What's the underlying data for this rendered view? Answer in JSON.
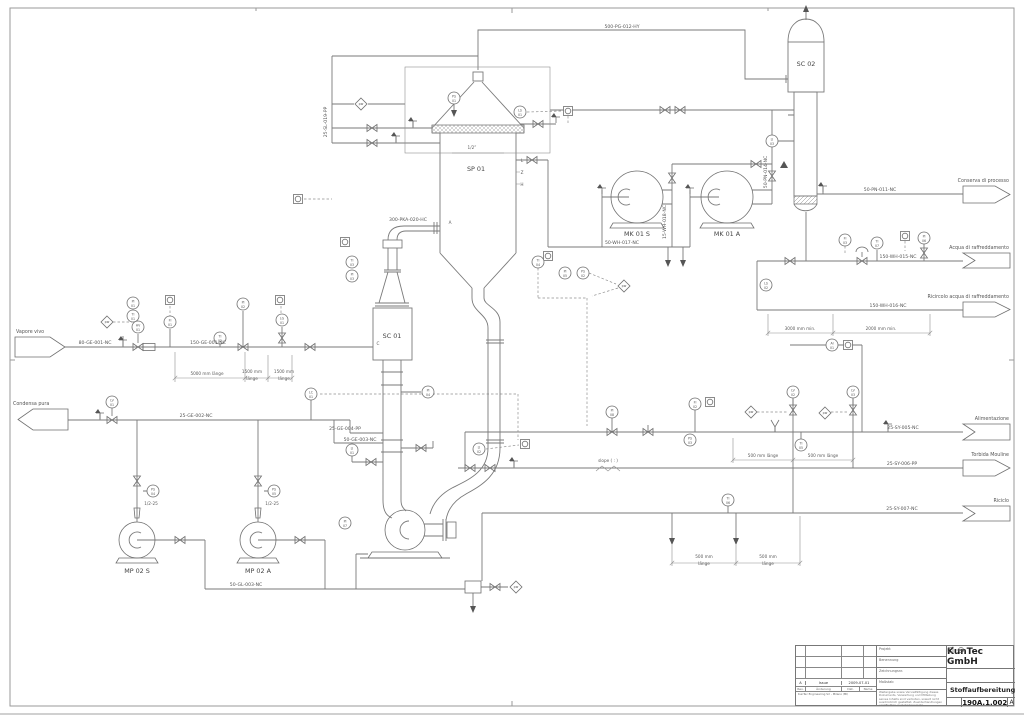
{
  "title_block": {
    "company": "KunTec GmbH",
    "drawing_title": "Stoffaufbereitung",
    "drawing_number": "190A.1.002",
    "revision": "A",
    "fields": [
      "Projekt",
      "Benennung",
      "Zeichnungsnr.",
      "Maßstab"
    ],
    "note": "Weitergabe sowie Vervielfältigung dieses Dokuments, Verwertung und Mitteilung seines Inhalts sind verboten, soweit nicht ausdrücklich gestattet. Zuwiderhandlungen verpflichten zu Schadenersatz.",
    "rev_row": {
      "rev": "A",
      "desc": "Issue",
      "date": "2009-07-01"
    },
    "rev_headers": [
      "Rev.",
      "Änderung",
      "Dat.",
      "Name"
    ],
    "footer": "KunTec Engineering Srl - Milano (MI)"
  },
  "diagram": {
    "equipment_labels": [
      {
        "text": "SC 02",
        "x": 806,
        "y": 66
      },
      {
        "text": "SP 01",
        "x": 476,
        "y": 171
      },
      {
        "text": "SC 01",
        "x": 392,
        "y": 338
      },
      {
        "text": "MK 01 S",
        "x": 637,
        "y": 236
      },
      {
        "text": "MK 01 A",
        "x": 727,
        "y": 236
      },
      {
        "text": "MP 02 S",
        "x": 137,
        "y": 573
      },
      {
        "text": "MP 02 A",
        "x": 258,
        "y": 573
      }
    ],
    "flags": [
      {
        "id": "vapore-vivo",
        "text": "Vapore vivo",
        "x": 15,
        "y": 337,
        "w": 50,
        "h": 20,
        "dir": "right",
        "lx": 16,
        "ly": 333,
        "anchor": "start"
      },
      {
        "id": "condensa-pura",
        "text": "Condensa pura",
        "x": 18,
        "y": 409,
        "w": 50,
        "h": 21,
        "dir": "left",
        "lx": 13,
        "ly": 405,
        "anchor": "start"
      },
      {
        "id": "conserva-di-processo",
        "text": "Conserva di processo",
        "x": 963,
        "y": 186,
        "w": 47,
        "h": 17,
        "dir": "right",
        "lx": 1009,
        "ly": 182,
        "anchor": "end"
      },
      {
        "id": "acqua-di-raffreddamento",
        "text": "Acqua di raffreddamento",
        "x": 963,
        "y": 253,
        "w": 47,
        "h": 15,
        "dir": "notch",
        "lx": 1009,
        "ly": 249,
        "anchor": "end"
      },
      {
        "id": "ricircolo-acqua",
        "text": "Ricircolo acqua di raffreddamento",
        "x": 963,
        "y": 302,
        "w": 47,
        "h": 15,
        "dir": "right",
        "lx": 1009,
        "ly": 298,
        "anchor": "end"
      },
      {
        "id": "alimentazione",
        "text": "Alimentazione",
        "x": 963,
        "y": 424,
        "w": 47,
        "h": 16,
        "dir": "notch",
        "lx": 1009,
        "ly": 420,
        "anchor": "end"
      },
      {
        "id": "torbida-mouline",
        "text": "Torbida Mouline",
        "x": 963,
        "y": 460,
        "w": 47,
        "h": 16,
        "dir": "right",
        "lx": 1009,
        "ly": 456,
        "anchor": "end"
      },
      {
        "id": "riciclo",
        "text": "Riciclo",
        "x": 963,
        "y": 506,
        "w": 47,
        "h": 15,
        "dir": "notch",
        "lx": 1009,
        "ly": 502,
        "anchor": "end"
      }
    ],
    "pipe_labels": [
      {
        "text": "500-PG-012-HY",
        "x": 622,
        "y": 28
      },
      {
        "text": "25-SL-019-PP",
        "x": 327,
        "y": 122,
        "rot": true
      },
      {
        "text": "300-PKA-020-HC",
        "x": 408,
        "y": 221
      },
      {
        "text": "80-GE-001-NC",
        "x": 95,
        "y": 344
      },
      {
        "text": "150-GE-001-NC",
        "x": 208,
        "y": 344
      },
      {
        "text": "25-GE-002-NC",
        "x": 196,
        "y": 417
      },
      {
        "text": "25-GE-004-PP",
        "x": 345,
        "y": 430
      },
      {
        "text": "50-GE-003-NC",
        "x": 360,
        "y": 441
      },
      {
        "text": "50-GL-003-NC",
        "x": 246,
        "y": 586
      },
      {
        "text": "50-WH-017-NC",
        "x": 622,
        "y": 244
      },
      {
        "text": "15-WH-018-NC",
        "x": 666,
        "y": 222,
        "rot": true
      },
      {
        "text": "50-PN-014-NC",
        "x": 767,
        "y": 172,
        "rot": true
      },
      {
        "text": "50-PN-011-NC",
        "x": 880,
        "y": 191
      },
      {
        "text": "150-WH-015-NC",
        "x": 898,
        "y": 258
      },
      {
        "text": "150-WH-016-NC",
        "x": 888,
        "y": 307
      },
      {
        "text": "25-SY-005-NC",
        "x": 903,
        "y": 429
      },
      {
        "text": "25-SY-006-PP",
        "x": 902,
        "y": 465
      },
      {
        "text": "25-SY-007-NC",
        "x": 902,
        "y": 510
      }
    ],
    "dimensions": [
      {
        "l1": "5000 mm länge",
        "l2": "",
        "x": 207,
        "y": 375
      },
      {
        "l1": "1500 mm",
        "l2": "länge",
        "x": 252,
        "y": 373
      },
      {
        "l1": "1500 mm",
        "l2": "länge",
        "x": 284,
        "y": 373
      },
      {
        "l1": "3000 mm min.",
        "l2": "",
        "x": 800,
        "y": 330
      },
      {
        "l1": "2000 mm min.",
        "l2": "",
        "x": 881,
        "y": 330
      },
      {
        "l1": "500 mm länge",
        "l2": "",
        "x": 763,
        "y": 457
      },
      {
        "l1": "500 mm länge",
        "l2": "",
        "x": 823,
        "y": 457
      },
      {
        "l1": "500 mm",
        "l2": "länge",
        "x": 704,
        "y": 558
      },
      {
        "l1": "500 mm",
        "l2": "länge",
        "x": 768,
        "y": 558
      }
    ],
    "notes": [
      {
        "text": "slope ( : )",
        "x": 608,
        "y": 462
      },
      {
        "text": "1/2”",
        "x": 472,
        "y": 149
      },
      {
        "text": "1/2-25",
        "x": 151,
        "y": 505
      },
      {
        "text": "1/2-25",
        "x": 272,
        "y": 505
      },
      {
        "text": "L",
        "x": 522,
        "y": 162
      },
      {
        "text": "Z",
        "x": 522,
        "y": 174
      },
      {
        "text": "H",
        "x": 522,
        "y": 186
      },
      {
        "text": "C",
        "x": 378,
        "y": 345
      },
      {
        "text": "A",
        "x": 450,
        "y": 224
      }
    ],
    "instruments": [
      {
        "x": 107,
        "y": 322,
        "l1": "pw",
        "l2": "",
        "shape": "d"
      },
      {
        "x": 133,
        "y": 303,
        "l1": "PI",
        "l2": "01",
        "shape": "c"
      },
      {
        "x": 133,
        "y": 316,
        "l1": "TI",
        "l2": "01",
        "shape": "c"
      },
      {
        "x": 170,
        "y": 300,
        "l1": "",
        "l2": "",
        "shape": "s"
      },
      {
        "x": 170,
        "y": 322,
        "l1": "FI",
        "l2": "01",
        "shape": "c"
      },
      {
        "x": 220,
        "y": 338,
        "l1": "TI",
        "l2": "02",
        "shape": "c"
      },
      {
        "x": 243,
        "y": 304,
        "l1": "PI",
        "l2": "02",
        "shape": "c"
      },
      {
        "x": 280,
        "y": 300,
        "l1": "",
        "l2": "",
        "shape": "s"
      },
      {
        "x": 282,
        "y": 320,
        "l1": "LG",
        "l2": "01",
        "shape": "c"
      },
      {
        "x": 311,
        "y": 394,
        "l1": "LC",
        "l2": "01",
        "shape": "c"
      },
      {
        "x": 112,
        "y": 402,
        "l1": "LV",
        "l2": "01",
        "shape": "c"
      },
      {
        "x": 138,
        "y": 327,
        "l1": "HV",
        "l2": "01",
        "shape": "c"
      },
      {
        "x": 345,
        "y": 242,
        "l1": "",
        "l2": "",
        "shape": "s"
      },
      {
        "x": 352,
        "y": 262,
        "l1": "TI",
        "l2": "03",
        "shape": "c"
      },
      {
        "x": 352,
        "y": 276,
        "l1": "PI",
        "l2": "03",
        "shape": "c"
      },
      {
        "x": 361,
        "y": 104,
        "l1": "pw",
        "l2": "",
        "shape": "d"
      },
      {
        "x": 454,
        "y": 98,
        "l1": "PS",
        "l2": "01",
        "shape": "c"
      },
      {
        "x": 520,
        "y": 112,
        "l1": "LS",
        "l2": "01",
        "shape": "c"
      },
      {
        "x": 568,
        "y": 111,
        "l1": "",
        "l2": "",
        "shape": "s"
      },
      {
        "x": 298,
        "y": 199,
        "l1": "",
        "l2": "",
        "shape": "s"
      },
      {
        "x": 548,
        "y": 256,
        "l1": "",
        "l2": "",
        "shape": "s"
      },
      {
        "x": 352,
        "y": 450,
        "l1": "LI",
        "l2": "01",
        "shape": "c"
      },
      {
        "x": 428,
        "y": 392,
        "l1": "PI",
        "l2": "04",
        "shape": "c"
      },
      {
        "x": 479,
        "y": 449,
        "l1": "LI",
        "l2": "02",
        "shape": "c"
      },
      {
        "x": 525,
        "y": 444,
        "l1": "",
        "l2": "",
        "shape": "s"
      },
      {
        "x": 538,
        "y": 262,
        "l1": "TI",
        "l2": "04",
        "shape": "c"
      },
      {
        "x": 565,
        "y": 273,
        "l1": "PI",
        "l2": "05",
        "shape": "c"
      },
      {
        "x": 583,
        "y": 273,
        "l1": "PS",
        "l2": "02",
        "shape": "c"
      },
      {
        "x": 624,
        "y": 286,
        "l1": "pw",
        "l2": "",
        "shape": "d"
      },
      {
        "x": 695,
        "y": 404,
        "l1": "FI",
        "l2": "02",
        "shape": "c"
      },
      {
        "x": 710,
        "y": 402,
        "l1": "",
        "l2": "",
        "shape": "s"
      },
      {
        "x": 690,
        "y": 440,
        "l1": "PS",
        "l2": "03",
        "shape": "c"
      },
      {
        "x": 751,
        "y": 412,
        "l1": "pw",
        "l2": "",
        "shape": "d"
      },
      {
        "x": 793,
        "y": 392,
        "l1": "LV",
        "l2": "02",
        "shape": "c"
      },
      {
        "x": 825,
        "y": 413,
        "l1": "pw",
        "l2": "",
        "shape": "d"
      },
      {
        "x": 853,
        "y": 392,
        "l1": "LV",
        "l2": "03",
        "shape": "c"
      },
      {
        "x": 801,
        "y": 445,
        "l1": "TI",
        "l2": "05",
        "shape": "c"
      },
      {
        "x": 728,
        "y": 500,
        "l1": "TI",
        "l2": "06",
        "shape": "c"
      },
      {
        "x": 612,
        "y": 412,
        "l1": "PI",
        "l2": "08",
        "shape": "c"
      },
      {
        "x": 832,
        "y": 345,
        "l1": "AI",
        "l2": "01",
        "shape": "c"
      },
      {
        "x": 848,
        "y": 345,
        "l1": "",
        "l2": "",
        "shape": "s"
      },
      {
        "x": 845,
        "y": 240,
        "l1": "FI",
        "l2": "03",
        "shape": "c"
      },
      {
        "x": 877,
        "y": 243,
        "l1": "TI",
        "l2": "07",
        "shape": "c"
      },
      {
        "x": 905,
        "y": 236,
        "l1": "",
        "l2": "",
        "shape": "s"
      },
      {
        "x": 924,
        "y": 238,
        "l1": "PI",
        "l2": "06",
        "shape": "c"
      },
      {
        "x": 772,
        "y": 141,
        "l1": "LI",
        "l2": "03",
        "shape": "c"
      },
      {
        "x": 766,
        "y": 285,
        "l1": "LS",
        "l2": "02",
        "shape": "c"
      },
      {
        "x": 153,
        "y": 491,
        "l1": "PS",
        "l2": "04",
        "shape": "c"
      },
      {
        "x": 274,
        "y": 491,
        "l1": "PS",
        "l2": "05",
        "shape": "c"
      },
      {
        "x": 345,
        "y": 523,
        "l1": "PI",
        "l2": "07",
        "shape": "c"
      },
      {
        "x": 516,
        "y": 587,
        "l1": "pw",
        "l2": "",
        "shape": "d"
      }
    ]
  }
}
